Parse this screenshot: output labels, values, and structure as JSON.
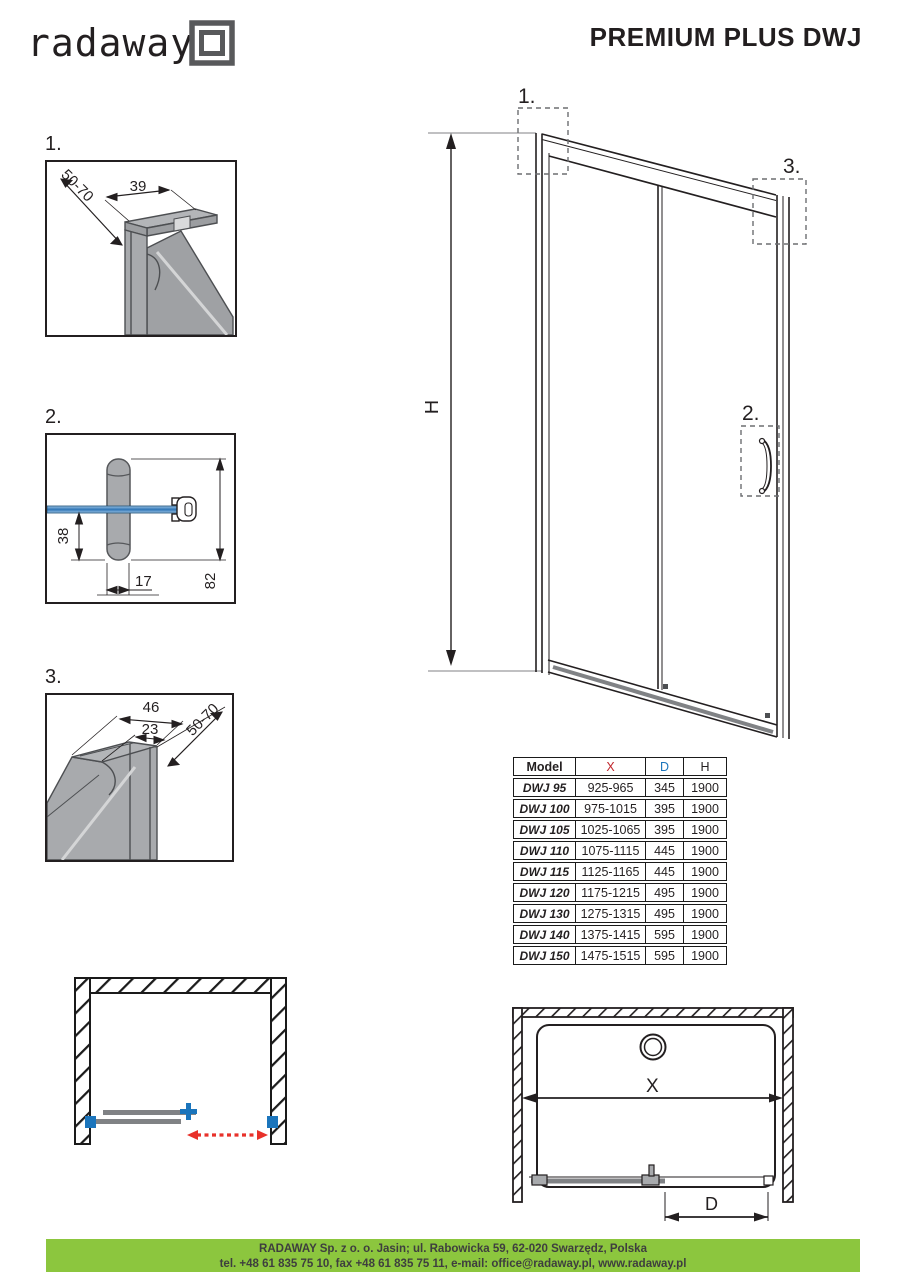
{
  "header": {
    "logo_text": "radaway",
    "title": "PREMIUM PLUS DWJ"
  },
  "details": {
    "d1": {
      "label": "1.",
      "dim_top": "39",
      "dim_diag": "50-70"
    },
    "d2": {
      "label": "2.",
      "dim_height": "38",
      "dim_width": "17",
      "dim_total": "82"
    },
    "d3": {
      "label": "3.",
      "dim_outer": "46",
      "dim_inner": "23",
      "dim_diag": "50-70"
    }
  },
  "elevation": {
    "marker1": "1.",
    "marker2": "2.",
    "marker3": "3.",
    "height_label": "H"
  },
  "plan": {
    "x_label": "X",
    "d_label": "D"
  },
  "table": {
    "headers": [
      {
        "label": "Model",
        "color": "#231f20"
      },
      {
        "label": "X",
        "color": "#c1272d"
      },
      {
        "label": "D",
        "color": "#1b75bc"
      },
      {
        "label": "H",
        "color": "#231f20"
      }
    ],
    "rows": [
      [
        "DWJ 95",
        "925-965",
        "345",
        "1900"
      ],
      [
        "DWJ 100",
        "975-1015",
        "395",
        "1900"
      ],
      [
        "DWJ 105",
        "1025-1065",
        "395",
        "1900"
      ],
      [
        "DWJ 110",
        "1075-1115",
        "445",
        "1900"
      ],
      [
        "DWJ 115",
        "1125-1165",
        "445",
        "1900"
      ],
      [
        "DWJ 120",
        "1175-1215",
        "495",
        "1900"
      ],
      [
        "DWJ 130",
        "1275-1315",
        "495",
        "1900"
      ],
      [
        "DWJ 140",
        "1375-1415",
        "595",
        "1900"
      ],
      [
        "DWJ 150",
        "1475-1515",
        "595",
        "1900"
      ]
    ]
  },
  "footer": {
    "line1": "RADAWAY Sp. z o. o. Jasin; ul. Rabowicka 59, 62-020 Swarzędz, Polska",
    "line2": "tel. +48 61 835 75 10, fax +48 61 835 75 11, e-mail: office@radaway.pl, www.radaway.pl",
    "bg": "#8cc63e"
  },
  "colors": {
    "line": "#231f20",
    "accent_red": "#c1272d",
    "accent_blue": "#1b75bc",
    "arrow_red": "#e8312a",
    "gray_fill": "#a8aaad",
    "track_gray": "#808285"
  }
}
